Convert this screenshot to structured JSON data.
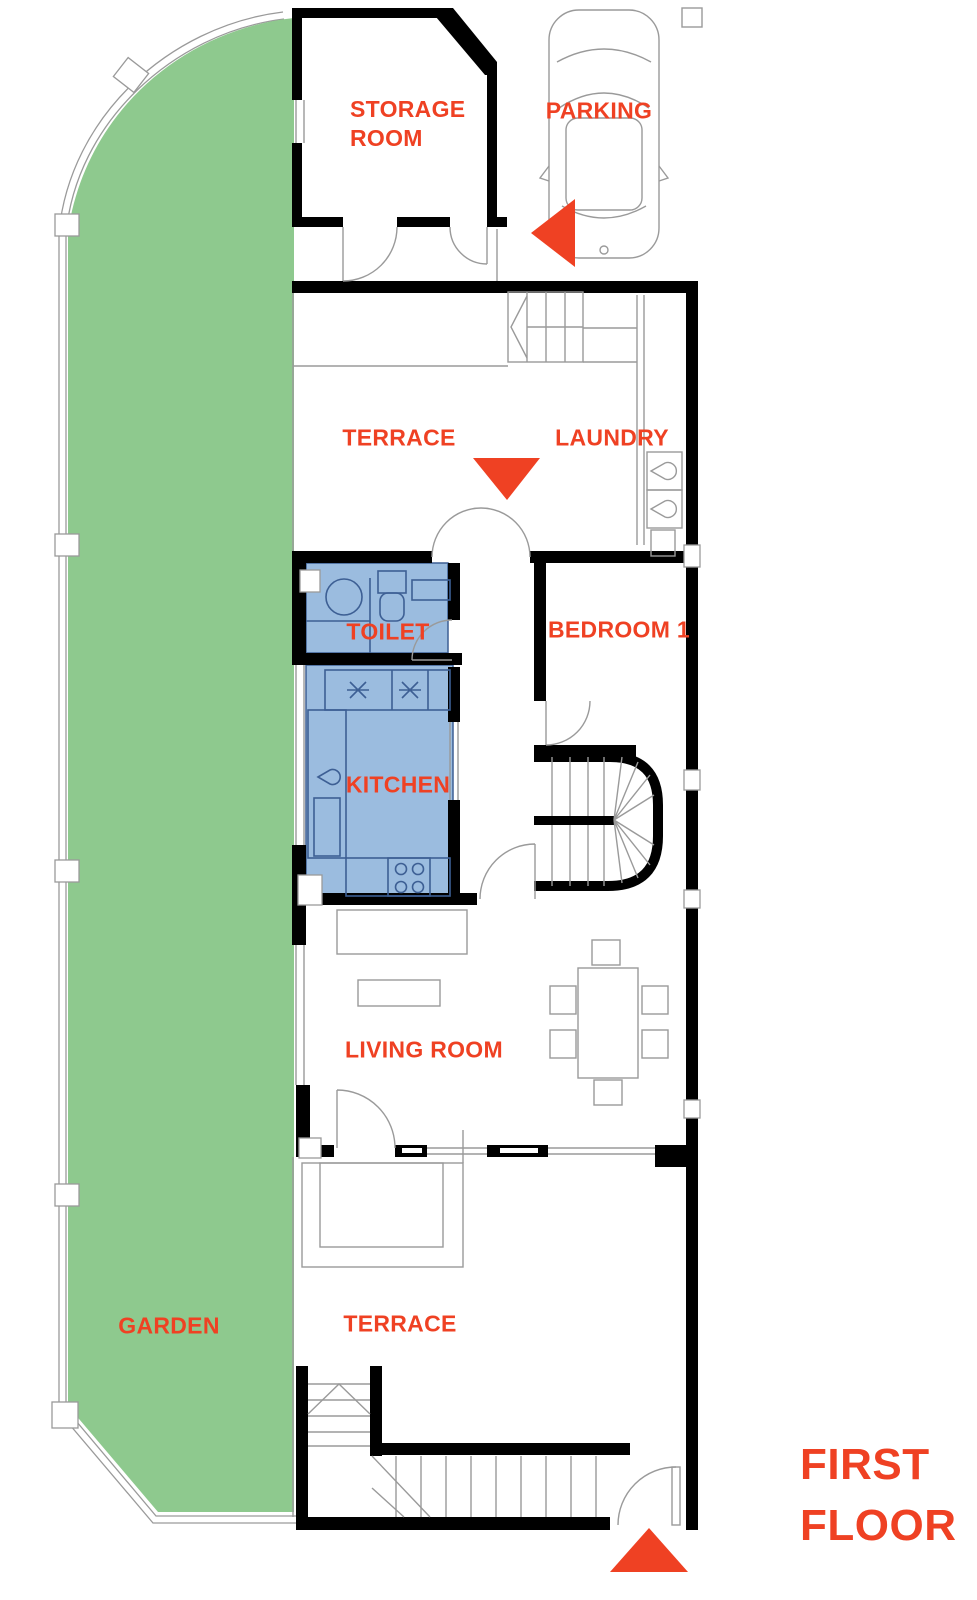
{
  "title": "FIRST\nFLOOR",
  "rooms": {
    "storage": "STORAGE\nROOM",
    "parking": "PARKING",
    "terrace_upper": "TERRACE",
    "laundry": "LAUNDRY",
    "toilet": "TOILET",
    "bedroom": "BEDROOM 1",
    "kitchen": "KITCHEN",
    "living": "LIVING ROOM",
    "garden": "GARDEN",
    "terrace_lower": "TERRACE"
  },
  "markers": {
    "parking_arrow": "triangle-left",
    "terrace_arrow": "triangle-down",
    "entrance_arrow": "triangle-up",
    "car": "car-top-view"
  },
  "colors": {
    "accent": "#ef4123",
    "garden_green": "#8ec98e",
    "wet_room_blue": "#9bbcdf",
    "fixture_blue": "#3d5f94",
    "wall_black": "#000000",
    "outline_gray": "#9a9a9a"
  }
}
